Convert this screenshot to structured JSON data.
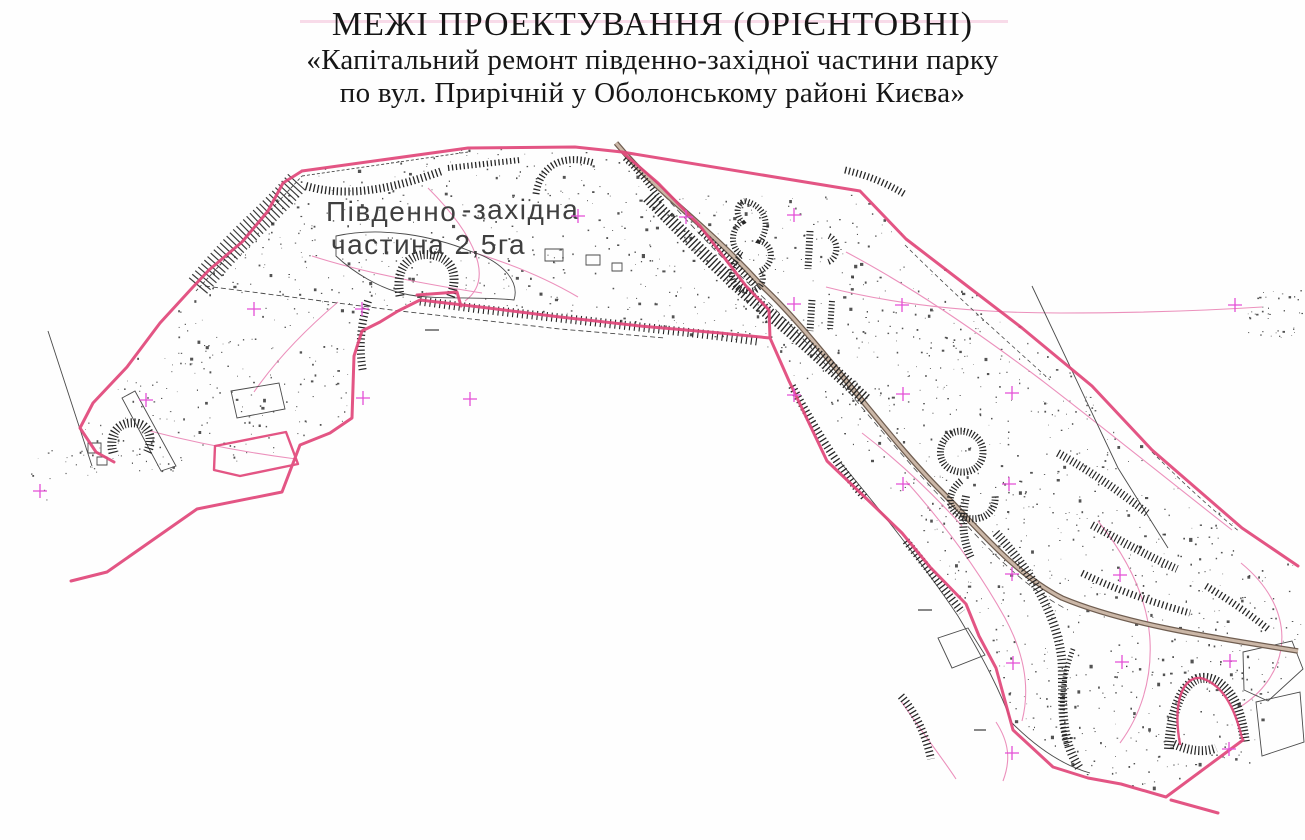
{
  "title": {
    "line1": "МЕЖІ ПРОЕКТУВАННЯ (ОРІЄНТОВНІ)",
    "line2": "«Капітальний ремонт південно-західної частини парку",
    "line3": "по вул. Прирічній у Оболонському районі Києва»"
  },
  "map": {
    "label": {
      "part1": "Південно",
      "part2": "-західна",
      "line2": "частина 2,5га"
    },
    "colors": {
      "boundary_pink": "#e1477a",
      "contour_pink": "#ea85b5",
      "grid_cross_magenta": "#e44fd6",
      "hatch_black": "#262626",
      "thin_black": "#4a4a4a",
      "road_dark": "#6f5d50",
      "road_fill": "#cbb7a7",
      "speckle": "#2d2d2d",
      "map_label_gray": "#3f3f3f",
      "micro_label_gray": "#888888",
      "background": "#fefefe"
    },
    "grid_crosses": [
      [
        578,
        216
      ],
      [
        686,
        217
      ],
      [
        794,
        215
      ],
      [
        254,
        309
      ],
      [
        362,
        309
      ],
      [
        794,
        304
      ],
      [
        902,
        305
      ],
      [
        1235,
        305
      ],
      [
        146,
        400
      ],
      [
        363,
        398
      ],
      [
        470,
        399
      ],
      [
        794,
        395
      ],
      [
        903,
        394
      ],
      [
        1012,
        393
      ],
      [
        40,
        491
      ],
      [
        903,
        484
      ],
      [
        1009,
        484
      ],
      [
        1012,
        574
      ],
      [
        1120,
        575
      ],
      [
        1013,
        663
      ],
      [
        1122,
        662
      ],
      [
        1230,
        661
      ],
      [
        1012,
        753
      ],
      [
        1229,
        749
      ]
    ]
  }
}
